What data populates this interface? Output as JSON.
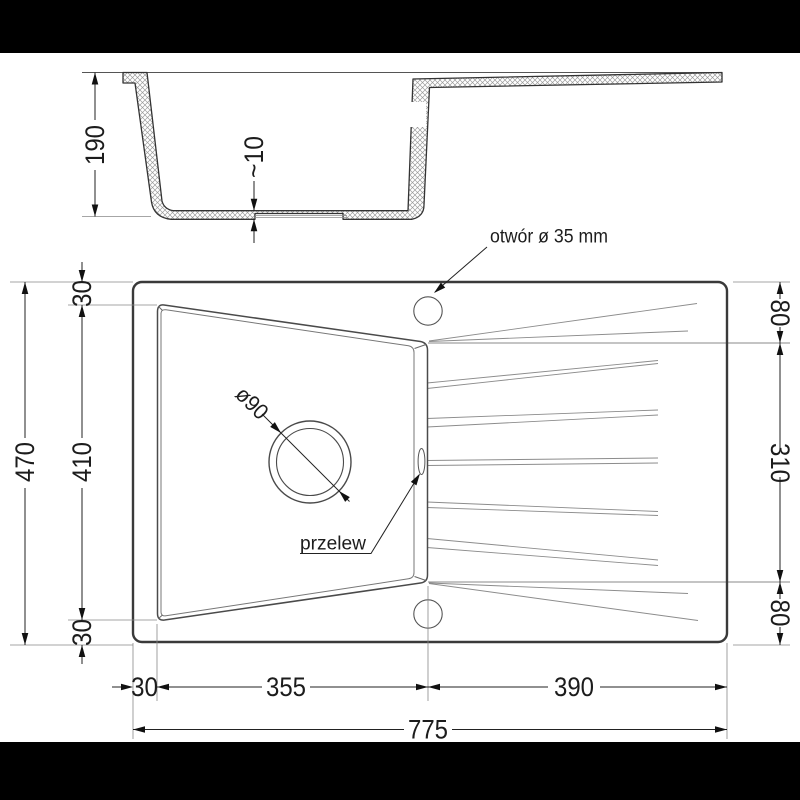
{
  "drawing": {
    "title_semantic": "sink-technical-drawing",
    "section_view": {
      "depth": "190",
      "bottom_thickness": "~10"
    },
    "plan_view": {
      "hole_label": "otwór ø 35 mm",
      "drain_diameter_label": "ø90",
      "overflow_label": "przelew",
      "left_dims": {
        "total_height": "470",
        "top_rim": "30",
        "bowl_height": "410",
        "bottom_rim": "30"
      },
      "right_dims": {
        "top_strip": "80",
        "drainer_height": "310",
        "bottom_strip": "80"
      },
      "bottom_dims": {
        "left_rim": "30",
        "bowl_width": "355",
        "drainer_width": "390",
        "total_width": "775"
      }
    },
    "colors": {
      "line_main": "#333333",
      "line_bold": "#3a3a3a",
      "line_light": "#8c8c8c",
      "hatch": "#9a9a9a",
      "letterbox": "#000000",
      "background": "#ffffff"
    }
  }
}
